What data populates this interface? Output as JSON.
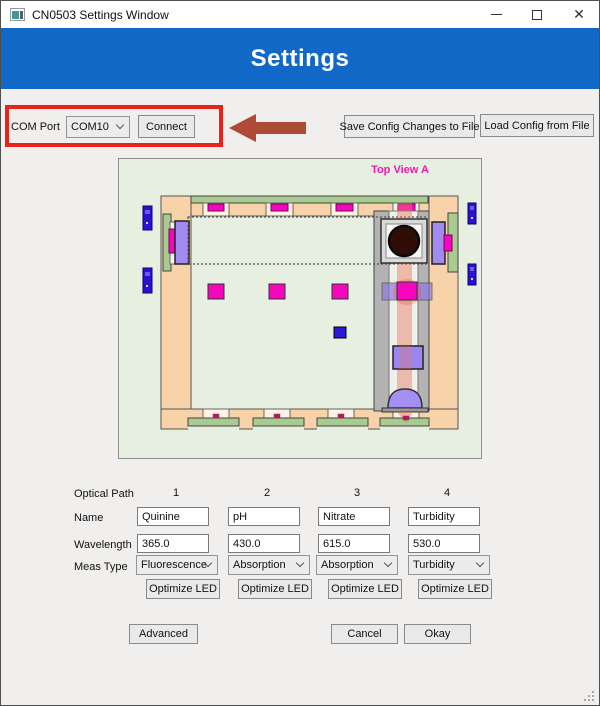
{
  "window": {
    "title": "CN0503 Settings Window",
    "close_glyph": "✕"
  },
  "header": {
    "title": "Settings",
    "bg_color": "#1168c6"
  },
  "com": {
    "label": "COM Port",
    "selected_port": "COM10",
    "connect_label": "Connect"
  },
  "config_buttons": {
    "save_label": "Save Config Changes to File",
    "load_label": "Load Config from File"
  },
  "annotation": {
    "highlight_color": "#e8231b",
    "arrow_color": "#ae4a38"
  },
  "diagram": {
    "label": "Top View A",
    "label_color": "#f218ad",
    "panel_color": "#e7efe1",
    "frame_color": "#f8d2a8",
    "led_color": "#f407bd",
    "optic_color": "#9c85ef",
    "beam_color": "#e8795a",
    "connector_color": "#2a12d4"
  },
  "paths": {
    "header_label": "Optical Path",
    "columns": [
      "1",
      "2",
      "3",
      "4"
    ],
    "name_label": "Name",
    "names": [
      "Quinine",
      "pH",
      "Nitrate",
      "Turbidity"
    ],
    "wavelength_label": "Wavelength",
    "wavelengths": [
      "365.0",
      "430.0",
      "615.0",
      "530.0"
    ],
    "meas_label": "Meas Type",
    "meas_types": [
      "Fluorescence",
      "Absorption",
      "Absorption",
      "Turbidity"
    ],
    "optimize_label": "Optimize LED"
  },
  "footer": {
    "advanced": "Advanced",
    "cancel": "Cancel",
    "okay": "Okay"
  }
}
